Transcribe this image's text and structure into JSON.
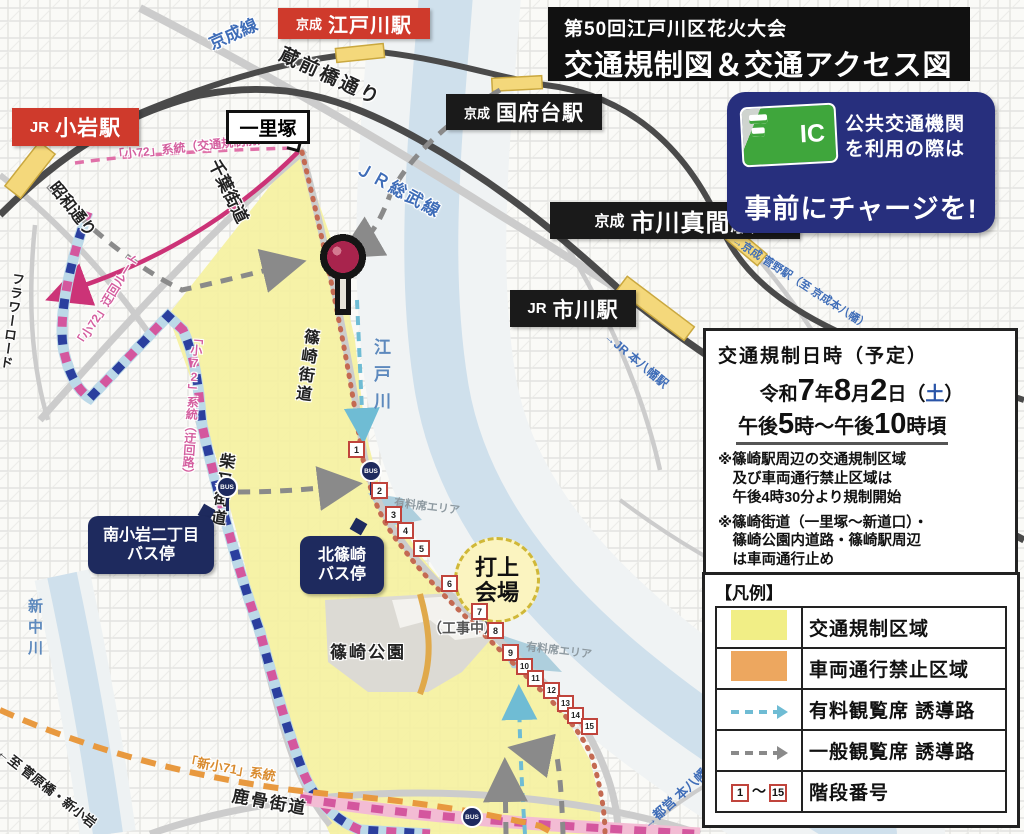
{
  "header": {
    "title_line1": "第50回江戸川区花火大会",
    "title_line2": "交通規制図＆交通アクセス図"
  },
  "ic_notice": {
    "card_text": "IC",
    "line1": "公共交通機関",
    "line2": "を利用の際は",
    "charge_line": "事前にチャージを!"
  },
  "info_box": {
    "heading": "交通規制日時（予定）",
    "date": {
      "era": "令和",
      "year": "7",
      "year_unit": "年",
      "month": "8",
      "month_unit": "月",
      "day": "2",
      "day_unit": "日",
      "wd_open": "（",
      "weekday": "土",
      "wd_close": "）"
    },
    "time": {
      "t1": "午後",
      "t2": "5",
      "t3": "時〜午後",
      "t4": "10",
      "t5": "時頃"
    },
    "note1_line1": "※篠崎駅周辺の交通規制区域",
    "note1_line2": "及び車両通行禁止区域は",
    "note1_line3": "午後4時30分より規制開始",
    "note2_line1": "※篠崎街道（一里塚〜新道口）・",
    "note2_line2": "篠崎公園内道路・篠崎駅周辺",
    "note2_line3": "は車両通行止め"
  },
  "legend": {
    "heading": "【凡例】",
    "rows": [
      {
        "label": "交通規制区域"
      },
      {
        "label": "車両通行禁止区域"
      },
      {
        "label": "有料観覧席 誘導路"
      },
      {
        "label": "一般観覧席 誘導路"
      },
      {
        "label": "階段番号",
        "from": "1",
        "tilde": "〜",
        "to": "15"
      }
    ]
  },
  "stations": {
    "keisei_edogawa": {
      "operator": "京成",
      "name": "江戸川駅"
    },
    "jr_koiwa": {
      "operator": "JR",
      "name": "小岩駅"
    },
    "keisei_konodai": {
      "operator": "京成",
      "name": "国府台駅"
    },
    "keisei_ichikawamama": {
      "operator": "京成",
      "name": "市川真間駅"
    },
    "jr_ichikawa": {
      "operator": "JR",
      "name": "市川駅"
    }
  },
  "map_labels": {
    "keisei_line": "京成線",
    "kuramaebashi": "蔵前橋通り",
    "jr_sobu": "ＪＲ総武線",
    "showa_dori": "昭和通り",
    "chiba_kaido": "千葉街道",
    "flower_road": "フラワーロード",
    "shibamata_kaido": "柴又街道",
    "shinozaki_kaido": "篠崎街道",
    "edogawa_river": "江戸川",
    "shin_nakagawa": "新中川",
    "shishibone_kaido": "鹿骨街道",
    "ichirizuka": "一里塚",
    "shinozaki_park": "篠崎公園",
    "under_construction": "（工事中）",
    "paid_seat_area": "有料席エリア",
    "uchiage_line1": "打上",
    "uchiage_line2": "会場",
    "route_k72_before": "「小72」系統（交通規制前）",
    "route_k72_detour_note": "「小72」迂回ルート",
    "route_k72_detour": "「小72」系統（迂回路）",
    "route_shin71": "「新小71」系統",
    "to_sugawara": "←至 菅原橋・新小岩",
    "to_keisei_sugano": "→京成 菅野駅（至 京成本八幡）",
    "to_jr_motoyawata": "→JR 本八幡駅",
    "to_toei_motoyawata": "→都営 本八幡駅"
  },
  "bus_stops": {
    "minami_koiwa_line1": "南小岩二丁目",
    "minami_koiwa_line2": "バス停",
    "kita_shinozaki_line1": "北篠崎",
    "kita_shinozaki_line2": "バス停",
    "bus_icon_text": "BUS"
  },
  "stairs": [
    "1",
    "2",
    "3",
    "4",
    "5",
    "6",
    "7",
    "8",
    "9",
    "10",
    "11",
    "12",
    "13",
    "14",
    "15"
  ],
  "colors": {
    "regulated_area": "#f5f1a0",
    "no_vehicle_zone": "#eda75f",
    "paid_route_teal": "#6fbcd4",
    "general_route_gray": "#8a8a8a",
    "stair_border_red": "#c0443c",
    "station_red": "#cf3a2c",
    "station_black": "#1a1a1a",
    "notice_navy": "#272f7d",
    "ic_green": "#3fa63c",
    "bus_navy": "#1e2a5e",
    "route_pink": "#d4579e",
    "route_blue": "#2b3f9e",
    "route_orange": "#e8993f"
  }
}
